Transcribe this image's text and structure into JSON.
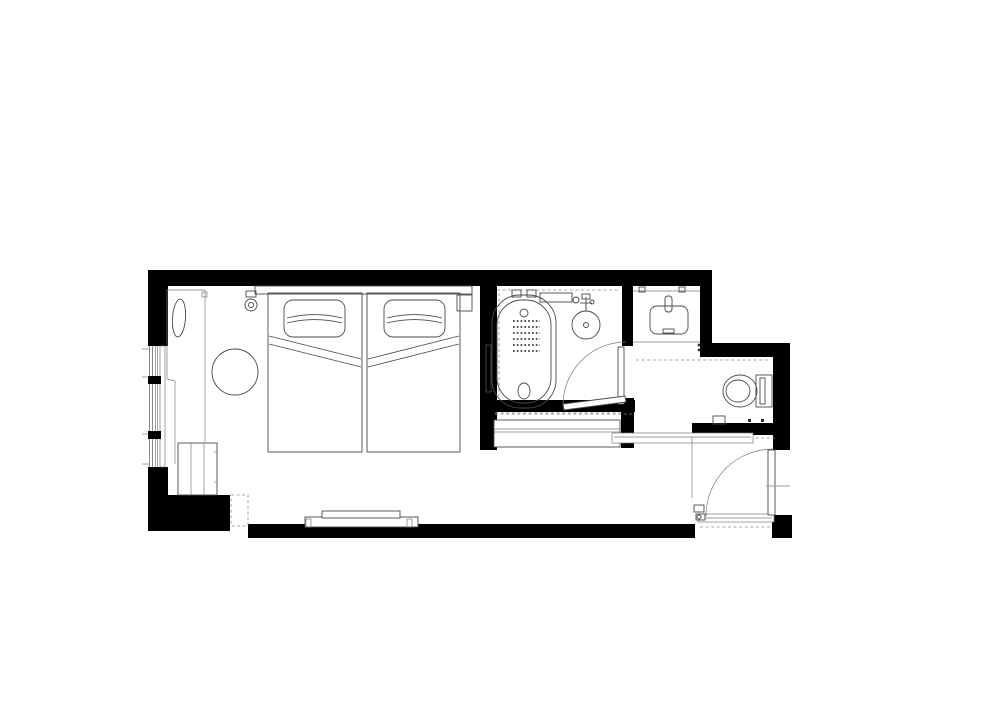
{
  "page": {
    "title": "Hotel Guest Room Floor Plan",
    "background_color": "#ffffff"
  },
  "drawing": {
    "kind": "architectural floor plan, black walls with thin furniture linework",
    "projection": "top-down plan view",
    "wall_fill": "#000000",
    "line_color": "#4a4a4a",
    "accent_dash_color": "#8a8a8a",
    "canvas_width": 1000,
    "canvas_height": 707
  },
  "rooms": {
    "bedroom": {
      "label": "Bedroom with twin beds"
    },
    "bathroom": {
      "label": "Bathroom with bathtub and washbasin"
    },
    "vanity": {
      "label": "Vanity alcove with basin"
    },
    "toilet": {
      "label": "Toilet area"
    },
    "closet": {
      "label": "Wardrobe closet"
    },
    "entry": {
      "label": "Entry corridor with entrance door"
    }
  },
  "furniture": {
    "bed1": {
      "label": "Twin bed (left)"
    },
    "bed2": {
      "label": "Twin bed (right)"
    },
    "headboard": {
      "label": "Headboard panel"
    },
    "nightstand": {
      "label": "Nightstand shelf"
    },
    "wall_light": {
      "label": "Wall-mounted reading light"
    },
    "round_table": {
      "label": "Round table"
    },
    "window_counter": {
      "label": "Window-side counter with bolster cushion"
    },
    "minibar": {
      "label": "Minibar cabinet"
    },
    "tv_console": {
      "label": "TV console"
    },
    "bathtub": {
      "label": "Bathtub with anti-slip mat"
    },
    "basin": {
      "label": "Round washbasin"
    },
    "shelf": {
      "label": "Bathroom shelf"
    },
    "grab_bar": {
      "label": "Grab bar"
    },
    "toilet_fixture": {
      "label": "Wall-hung toilet"
    },
    "luggage_bench": {
      "label": "Luggage bench"
    },
    "wardrobe": {
      "label": "Wardrobe with hanging rail"
    },
    "window": {
      "label": "Window with mullions"
    },
    "bathroom_door": {
      "label": "Bathroom swing door"
    },
    "entry_door": {
      "label": "Entrance swing door"
    }
  }
}
